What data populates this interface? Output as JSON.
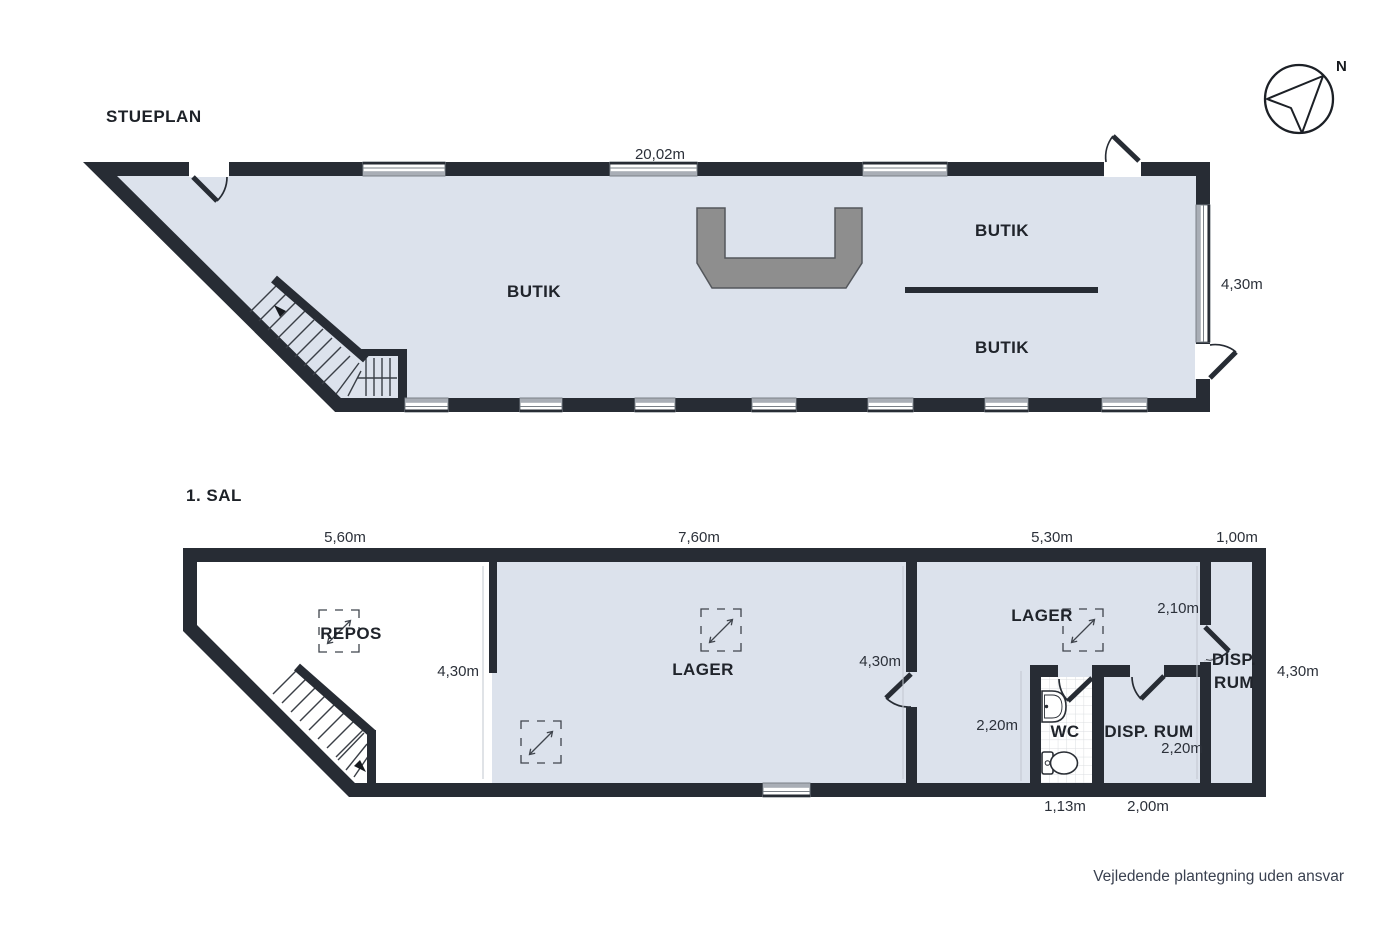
{
  "colors": {
    "wall": "#272c34",
    "floor": "#dce2ec",
    "counter": "#8e8e8e",
    "window_strip": "#a9aeb6"
  },
  "compass": {
    "north_label": "N"
  },
  "footer": {
    "note": "Vejledende plantegning uden ansvar"
  },
  "stueplan": {
    "title": "STUEPLAN",
    "rooms": {
      "butik_center": "BUTIK",
      "butik_upper": "BUTIK",
      "butik_lower": "BUTIK"
    },
    "dims": {
      "width": "20,02m",
      "depth_right": "4,30m"
    }
  },
  "sal1": {
    "title": "1. SAL",
    "rooms": {
      "repos": "REPOS",
      "lager_center": "LAGER",
      "lager_right": "LAGER",
      "wc": "WC",
      "disp_rum_center": "DISP. RUM",
      "disp_rum_right_line1": "DISP.",
      "disp_rum_right_line2": "RUM"
    },
    "dims": {
      "repos_width": "5,60m",
      "lager_width": "7,60m",
      "lager_right_width": "5,30m",
      "disp_right_width": "1,00m",
      "repos_depth": "4,30m",
      "lager_depth": "4,30m",
      "right_depth": "4,30m",
      "disp_right_wall": "2,10m",
      "wc_depth": "2,20m",
      "disp_center_depth": "2,20m",
      "wc_width": "1,13m",
      "disp_center_width": "2,00m"
    }
  }
}
